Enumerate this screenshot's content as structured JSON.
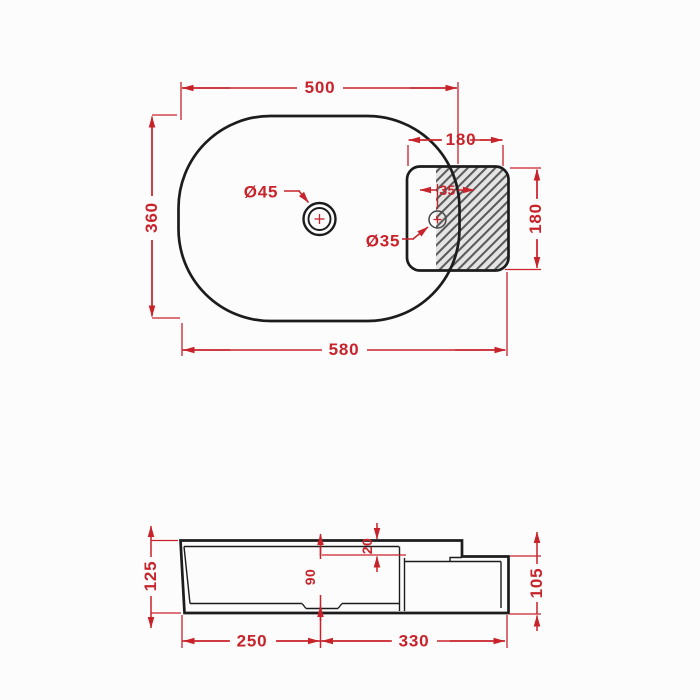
{
  "document": {
    "type": "technical-dimension-drawing",
    "subject": "oval countertop washbasin with side ledge, top view and front section view",
    "units": "mm"
  },
  "colors": {
    "background": "#fcfcfc",
    "outline": "#1c1c1c",
    "dimension": "#c8222a",
    "hatch_line": "#5a5a5a",
    "hatch_bg": "#e4e4e4"
  },
  "top_view": {
    "basin_width": "500",
    "overall_width": "580",
    "overall_depth": "360",
    "ledge_width": "180",
    "ledge_depth": "180",
    "faucet_hole_diameter": "Ø45",
    "drain_hole_diameter": "Ø35",
    "drain_edge_offset": "35"
  },
  "side_view": {
    "front_height": "125",
    "rear_height": "105",
    "step_height": "20",
    "basin_inner_depth": "90",
    "bottom_front_length": "250",
    "bottom_rear_length": "330"
  }
}
